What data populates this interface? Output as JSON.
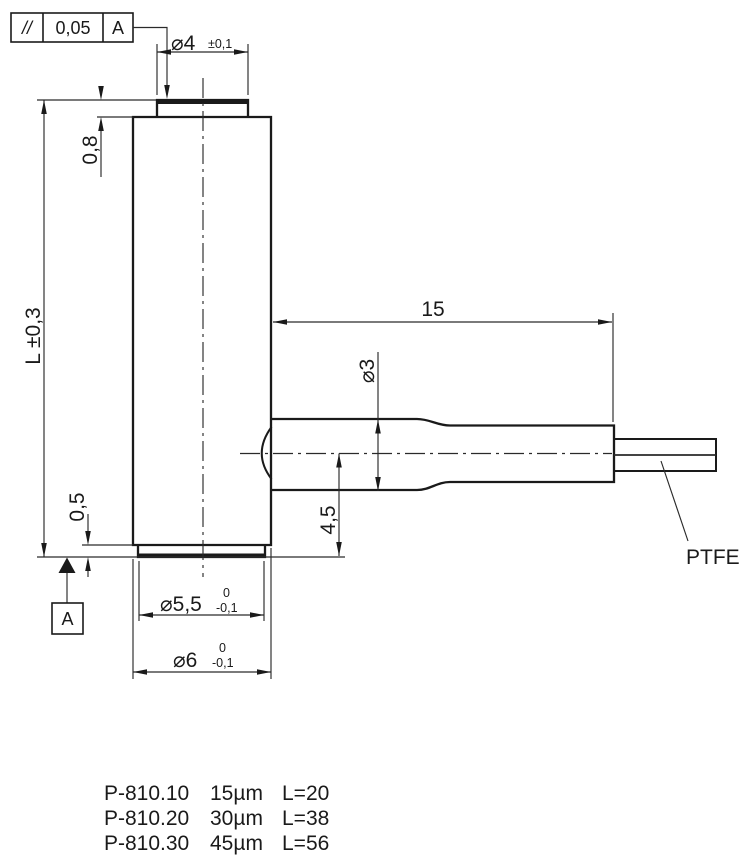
{
  "tolerance_frame": {
    "symbol": "//",
    "value": "0,05",
    "datum": "A"
  },
  "datum": {
    "label": "A"
  },
  "dimensions": {
    "top_diameter": {
      "value": "⌀4",
      "tolerance": "±0,1"
    },
    "top_cap_thickness": "0,8",
    "body_length": "L ±0,3",
    "bottom_cap_thickness": "0,5",
    "bottom_inner_diameter": {
      "value": "⌀5,5",
      "tol_upper": "0",
      "tol_lower": "-0,1"
    },
    "body_diameter": {
      "value": "⌀6",
      "tol_upper": "0",
      "tol_lower": "-0,1"
    },
    "sleeve_length": "15",
    "sleeve_diameter": "⌀3",
    "sleeve_axis_height": "4,5",
    "cable_material": "PTFE"
  },
  "models": [
    {
      "name": "P-810.10",
      "travel": "15µm",
      "length": "L=20"
    },
    {
      "name": "P-810.20",
      "travel": "30µm",
      "length": "L=38"
    },
    {
      "name": "P-810.30",
      "travel": "45µm",
      "length": "L=56"
    }
  ]
}
